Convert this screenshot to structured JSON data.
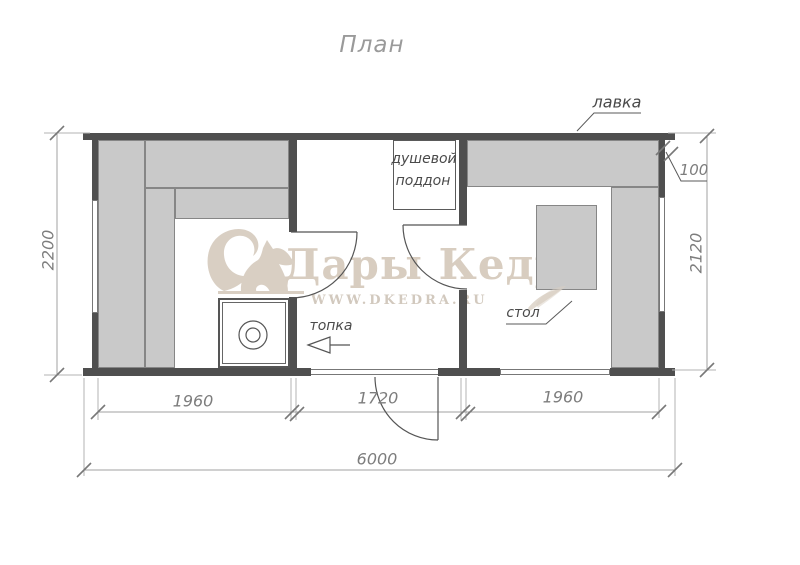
{
  "title": "План",
  "watermark": {
    "brand": "Дары Кедра",
    "url": "WWW.DKEDRA.RU"
  },
  "labels": {
    "bench": "лавка",
    "shower_line1": "душевой",
    "shower_line2": "поддон",
    "furnace": "топка",
    "table": "стол"
  },
  "dimensions": {
    "left_room_width": "1960",
    "middle_room_width": "1720",
    "right_room_width": "1960",
    "total_width": "6000",
    "left_height": "2200",
    "right_height": "2120",
    "wall_offset": "100"
  },
  "colors": {
    "wall": "#4f4f4f",
    "furniture_fill": "#c9c9c9",
    "watermark": "#d8cdc0",
    "dimension": "#7d7d7d",
    "label": "#4a4a4a"
  }
}
